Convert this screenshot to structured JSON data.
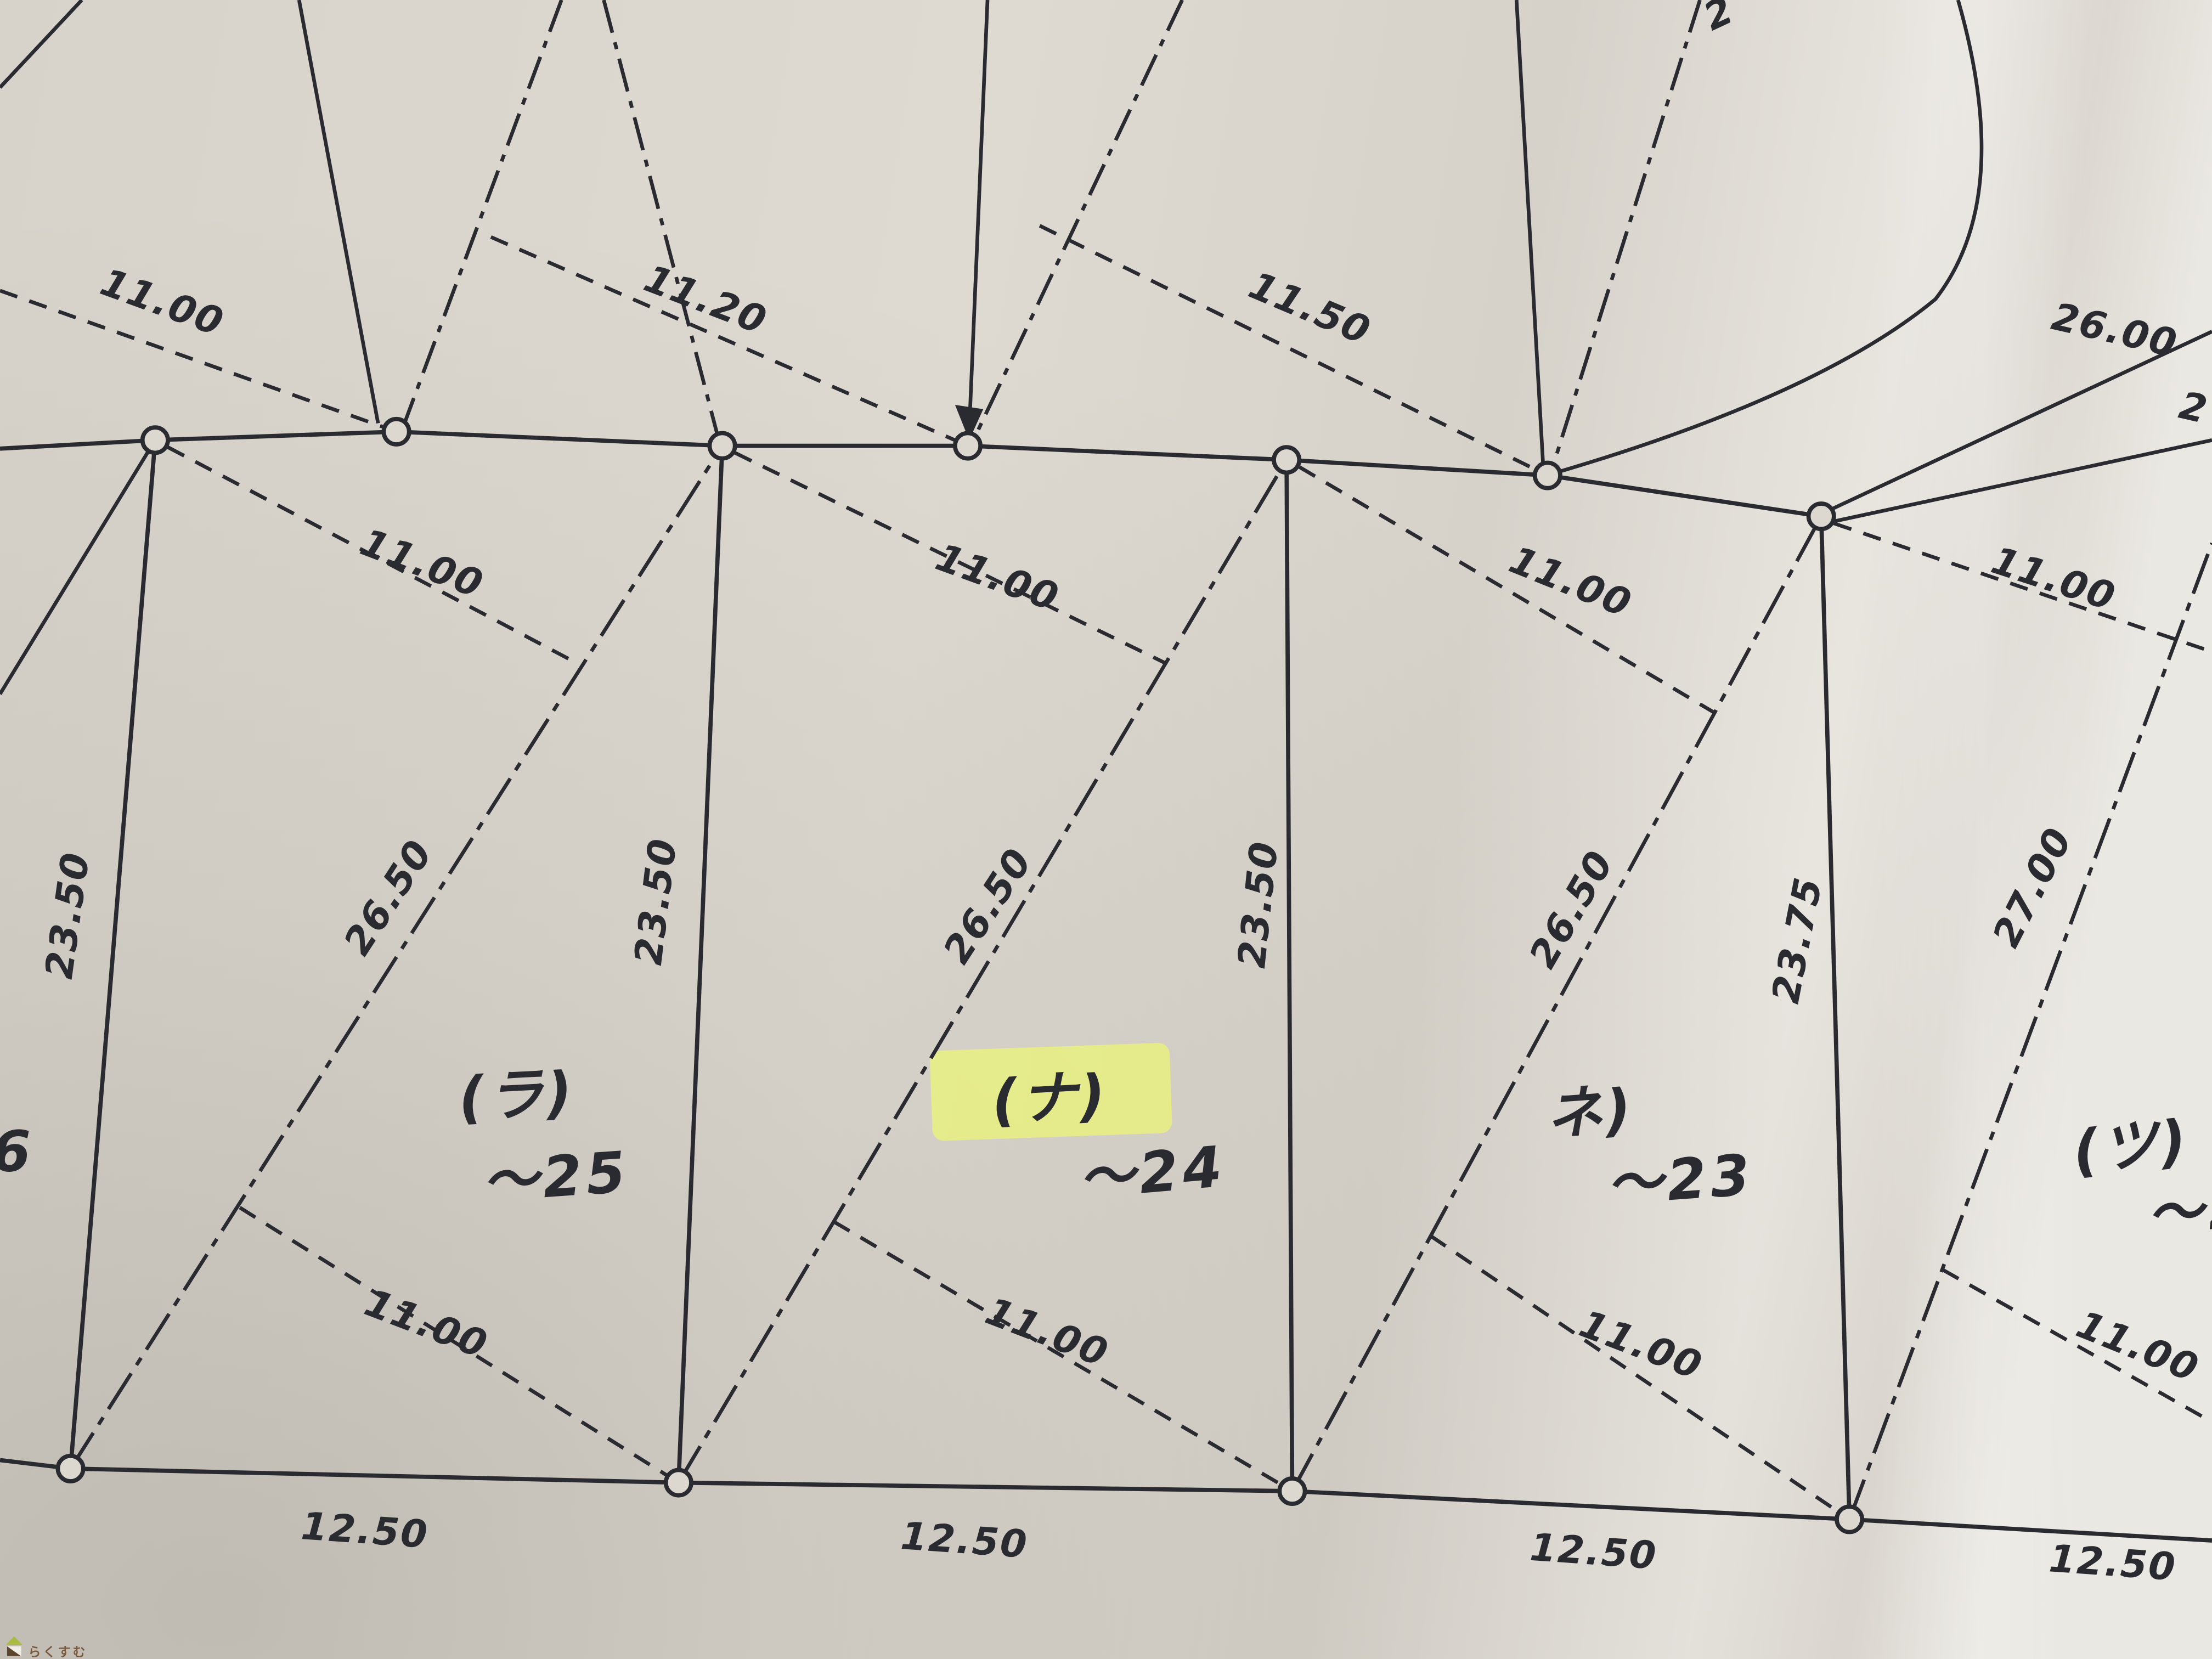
{
  "measurements": {
    "top": [
      "11.00",
      "11.20",
      "11.50"
    ],
    "top_right": [
      "26.00",
      "2"
    ],
    "top_edge_partial": "2",
    "upper_ties": [
      "11.00",
      "11.00",
      "11.00",
      "11.00"
    ],
    "verticals": [
      "23.50",
      "23.50",
      "23.50",
      "23.75"
    ],
    "diagonals": [
      "26.50",
      "26.50",
      "26.50",
      "27.00"
    ],
    "lower_ties": [
      "11.00",
      "11.00",
      "11.00",
      "11.00"
    ],
    "bottom": [
      "12.50",
      "12.50",
      "12.50",
      "12.50"
    ]
  },
  "plots": {
    "left_partial_number": "6",
    "items": [
      {
        "kana": "(ラ)",
        "number": "〜25"
      },
      {
        "kana": "(ナ)",
        "number": "〜24",
        "highlighted": true
      },
      {
        "kana": "ネ)",
        "number": "〜23"
      },
      {
        "kana": "(ツ)",
        "number": "〜2"
      }
    ]
  },
  "watermark": {
    "site": "らくすむ"
  },
  "colors": {
    "ink": "#2a2a31",
    "paper": "#dcd8d0",
    "highlight": "#e6ee86",
    "watermark_text": "#7a5a3f",
    "watermark_roof": "#a9bb44",
    "watermark_body": "#5c452f"
  }
}
